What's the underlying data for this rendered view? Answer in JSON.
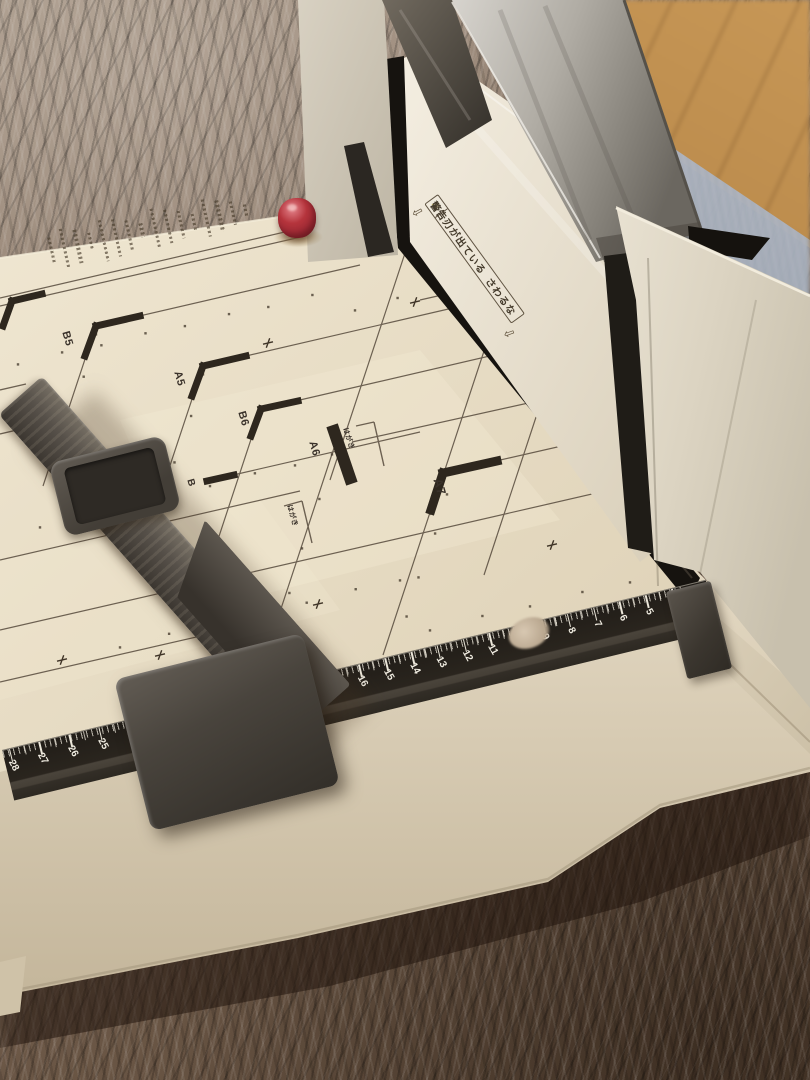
{
  "machine": {
    "warning_ribbon": {
      "icon": "⚠",
      "title": "警告",
      "message_1": "刃が出ている",
      "message_2": "さわるな",
      "start_arrow": "⇩",
      "end_arrow": "⇩"
    },
    "size_marks": {
      "b5": "B5",
      "a5": "A5",
      "b6": "B6",
      "a6": "A6",
      "a7": "A7",
      "b7_partial": "B",
      "hagaki_upper": "はがき",
      "hagaki_lower": "はがき"
    },
    "ruler": {
      "visible_numbers": [
        4,
        5,
        6,
        7,
        8,
        9,
        11,
        12,
        13,
        14,
        15,
        16,
        17,
        18,
        24,
        25,
        26,
        27,
        28
      ]
    }
  },
  "colors": {
    "body_cream": "#ddd2bc",
    "deck_paper": "#eadfc6",
    "print_ink": "#46392c",
    "ruler_black": "#201c17",
    "machine_dark_gray": "#45403a",
    "knob_red": "#b5343c",
    "blade_metal": "#a8a49d",
    "carpet_brown": "#7a6656",
    "wood_floor": "#bd9257",
    "rug_blue": "#939fae"
  }
}
